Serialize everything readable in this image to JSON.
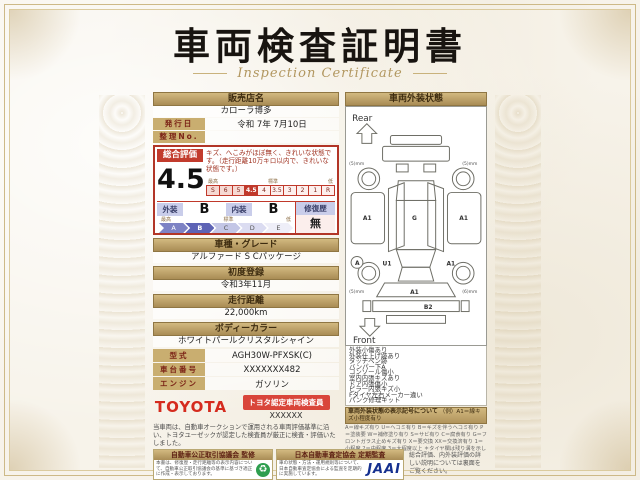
{
  "certificate": {
    "title": "車両検査証明書",
    "subtitle": "Inspection Certificate"
  },
  "left": {
    "dealer": {
      "label": "販売店名",
      "value": "カローラ博多"
    },
    "issue_date": {
      "label": "発行日",
      "value": "令和 7年 7月10日"
    },
    "ref_no": {
      "label": "整理No.",
      "value": ""
    },
    "evaluation": {
      "label": "総合評価",
      "score": "4.5",
      "description": "キズ、へこみがほぼ無く、きれいな状態です。（走行距離10万キロ以内で、きれいな状態です。）",
      "scale_high": "最高",
      "scale_mid": "標準",
      "scale_low": "低",
      "scale": [
        "S",
        "6",
        "5",
        "4.5",
        "4",
        "3.5",
        "3",
        "2",
        "1",
        "R"
      ],
      "exterior_label": "外装",
      "exterior_grade": "B",
      "interior_label": "内装",
      "interior_grade": "B",
      "repair_label": "修復歴",
      "repair_value": "無",
      "letter_scale": [
        "A",
        "B",
        "C",
        "D",
        "E"
      ]
    },
    "model": {
      "label": "車種・グレード",
      "value": "アルファード S Cパッケージ"
    },
    "first_reg": {
      "label": "初度登録",
      "value": "令和3年11月"
    },
    "mileage": {
      "label": "走行距離",
      "value": "22,000km"
    },
    "body_color": {
      "label": "ボディーカラー",
      "value": "ホワイトパールクリスタルシャイン"
    },
    "model_code": {
      "label": "型式",
      "value": "AGH30W-PFXSK(C)"
    },
    "chassis_no": {
      "label": "車台番号",
      "value": "XXXXXXX482"
    },
    "engine": {
      "label": "エンジン",
      "value": "ガソリン"
    },
    "toyota": {
      "brand": "TOYOTA",
      "badge": "トヨタ認定車両検査員",
      "inspector": "XXXXXX"
    },
    "disclaimer": "当車両は、自動車オークションで運用される車両評価基準に沿い、トヨタユーゼックが認定した検査員が厳正に検査・評価いたしました。"
  },
  "right": {
    "header": "車両外装状態",
    "diagram": {
      "rear_label": "Rear",
      "front_label": "Front",
      "rear_tread_left": "(5)mm",
      "rear_tread_right": "(5)mm",
      "front_tread_left": "(5)mm",
      "front_tread_right": "(6)mm",
      "left_quarter": "A1",
      "right_quarter": "A1",
      "roof": "G",
      "front_left_wheel_mark": "A",
      "front_left_dent": "U1",
      "front_right_mark": "A1",
      "front_bumper": "A1",
      "under_bumper": "B2"
    },
    "notes": [
      "外装小傷あり",
      "外装仕上げ跡あり",
      "タッチペン跡",
      "バンパー下A",
      "コンソール傷小",
      "室内内張キズあり",
      "ドア内張傷小",
      "ピラー内張キズ小",
      "Fタイヤ左右メーカー違い",
      "パンク修理キット"
    ],
    "symbols_header": "車両外装状態の表示記号について",
    "symbols_example": "（例）A1＝線キズ小程度有り",
    "symbols_legend": "A＝線キズ有り U＝ヘコミ有り B＝キズを伴うヘコミ有り P＝塗装要 W＝補修塗り有り S＝サビ有り C＝腐食有り G＝フロントガラス止めキズ有り X＝要交換 XX＝交換済有り 1＝小程度 2＝中程度 3＝大程度以上 ＊タイヤ欄は残り溝を示しています。"
  },
  "footer": {
    "council": {
      "title": "自動車公正取引協議会 監修",
      "text": "本書は、修復歴・走行距離等の表示内容について、自動車公正取引協議会の基準に基づき適正に作成・表示しております。"
    },
    "jaai": {
      "title": "日本自動車査定協会 定期監査",
      "text": "車の状態・方法・運用規則等について、日本自動車査定協会による監査を定期的に実施しています。",
      "logo": "JAAI"
    },
    "back_note": "総合評価、内外装評価の詳しい説明については裏面をご覧ください。"
  }
}
